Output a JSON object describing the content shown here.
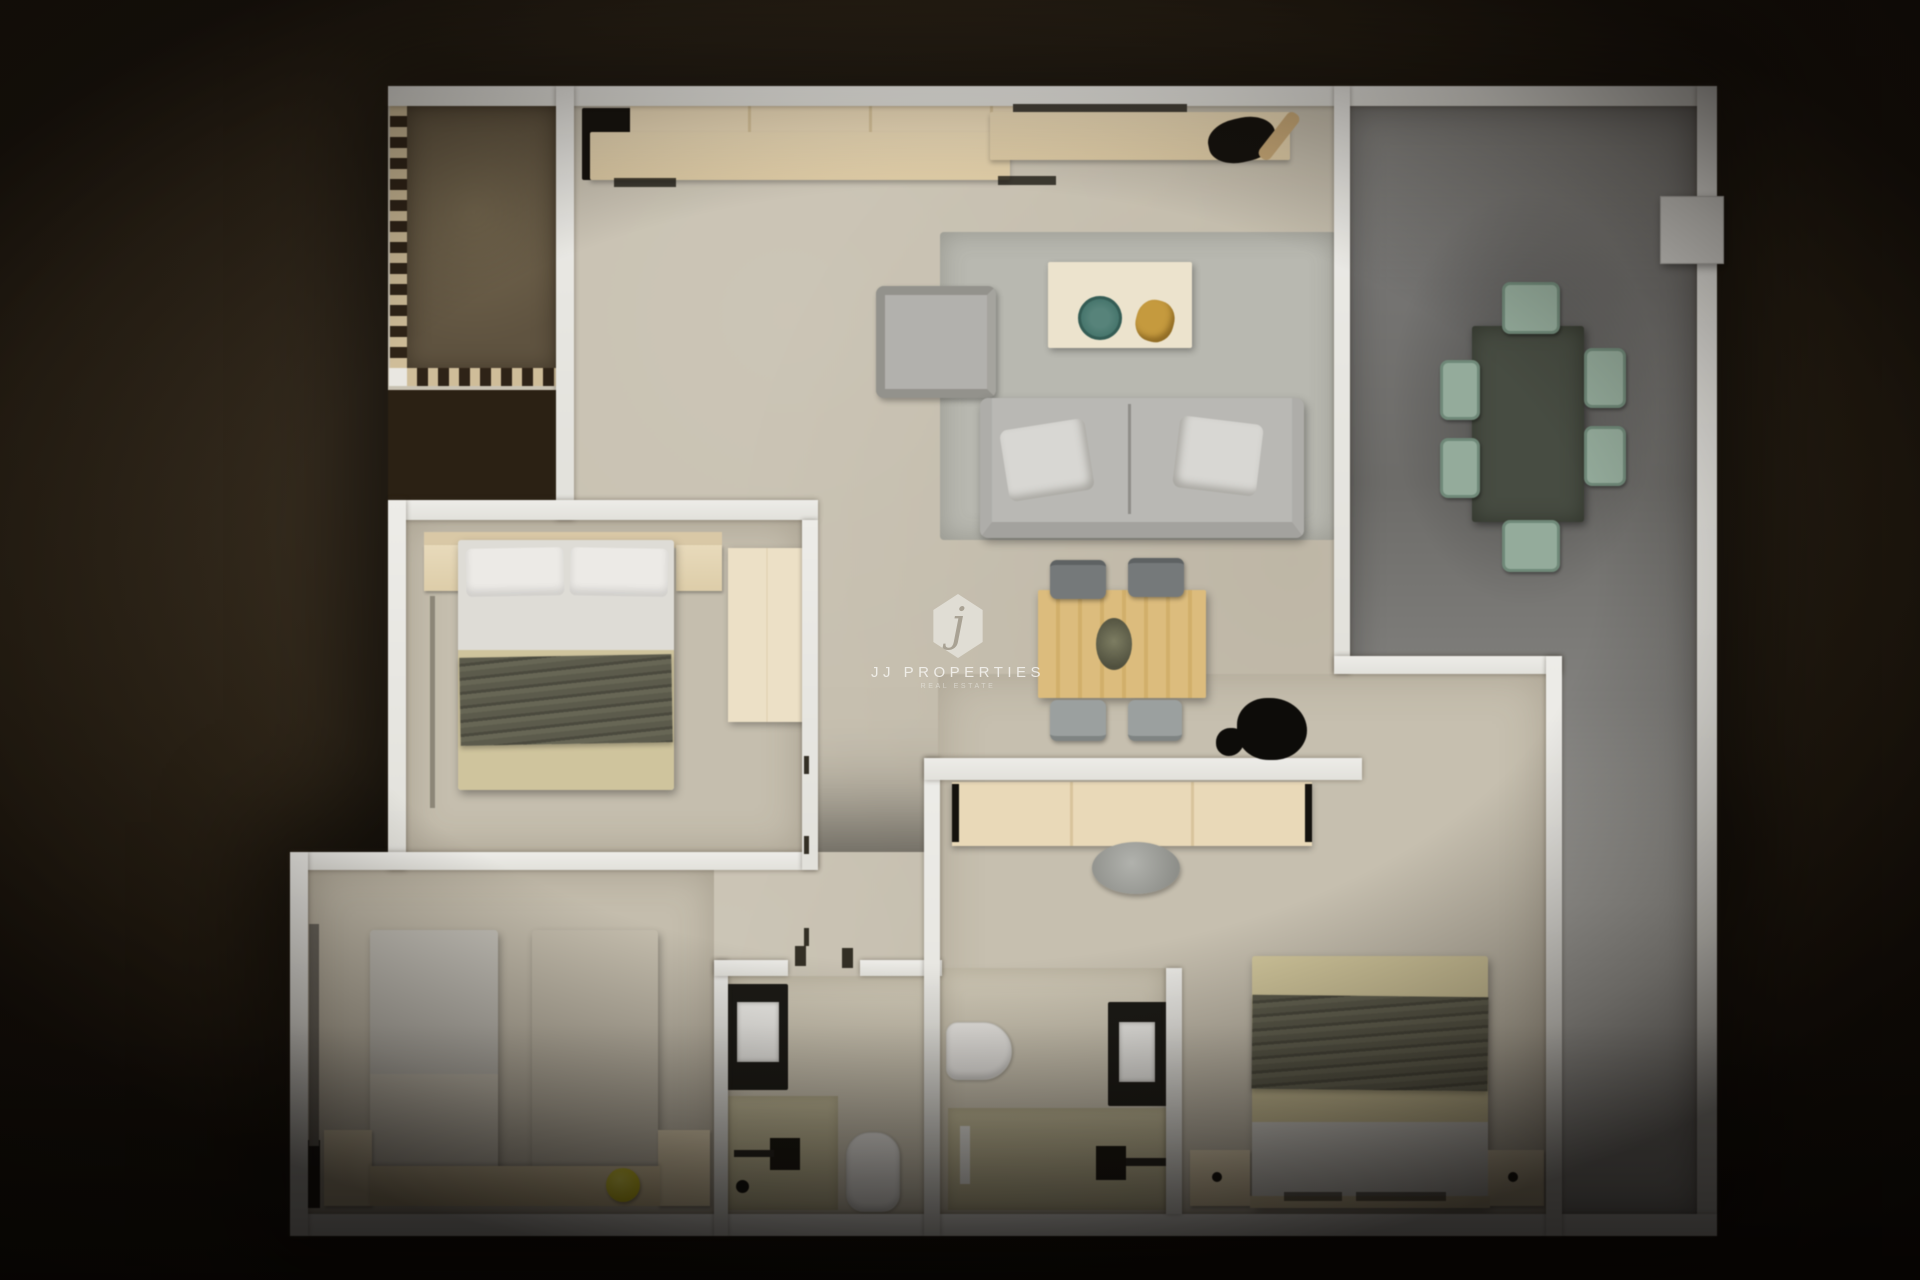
{
  "watermark": {
    "initial": "j",
    "brand": "JJ PROPERTIES",
    "tagline": "REAL ESTATE"
  },
  "colors": {
    "background": "#2e2518",
    "wall": "#e9e8e3",
    "floor": "#c8c1b1",
    "bath_floor": "#cfc8b6",
    "balcony_brown": "#6a5e49",
    "dash_beige": "#cfbd99",
    "terrace_dark": "#6f6e6b",
    "terrace_light": "#b2b1ad",
    "rug_gray": "#b8b8b0",
    "wood_table": "#d9b878",
    "sage_chair": "#94ab9b",
    "khaki_blanket": "#cfc49d",
    "olive_throw": "#5a594a",
    "vanity_khaki": "#c8c09c",
    "stool_yellow": "#d6ca2d",
    "plate_teal": "#49786f",
    "decor_gold": "#c59a3e",
    "appliance_black": "#15120e",
    "linen_white": "#e8e7e3"
  },
  "floor_plan": {
    "type": "apartment-top-down-3d-render",
    "rooms": [
      {
        "name": "balcony",
        "features": [
          "dashed-railing",
          "brown-floor"
        ]
      },
      {
        "name": "kitchen",
        "furniture": [
          "refrigerator",
          "cabinet-row",
          "counter",
          "sink",
          "faucet"
        ]
      },
      {
        "name": "living-room",
        "furniture": [
          "area-rug",
          "sofa",
          "two-pillows",
          "armchair",
          "coffee-table",
          "teal-plate",
          "gold-decor"
        ]
      },
      {
        "name": "dining-area",
        "furniture": [
          "wood-dining-table",
          "four-gray-chairs",
          "centerpiece",
          "black-plant"
        ]
      },
      {
        "name": "terrace",
        "furniture": [
          "outdoor-dining-table",
          "six-sage-chairs",
          "ac-unit"
        ]
      },
      {
        "name": "bedroom-1",
        "furniture": [
          "double-bed",
          "two-pillows",
          "two-nightstands",
          "wardrobe"
        ]
      },
      {
        "name": "bedroom-2",
        "furniture": [
          "single-bed",
          "single-bed",
          "two-nightstands",
          "headboard-bench",
          "yellow-stool",
          "wardrobe-doors"
        ]
      },
      {
        "name": "bathroom-1",
        "furniture": [
          "shower",
          "vanity-sink",
          "toilet"
        ]
      },
      {
        "name": "bathroom-2",
        "furniture": [
          "shower",
          "vanity-sink",
          "toilet",
          "towel"
        ]
      },
      {
        "name": "bedroom-3",
        "furniture": [
          "double-bed",
          "two-nightstands",
          "console-closet",
          "desk-chair"
        ]
      }
    ]
  }
}
